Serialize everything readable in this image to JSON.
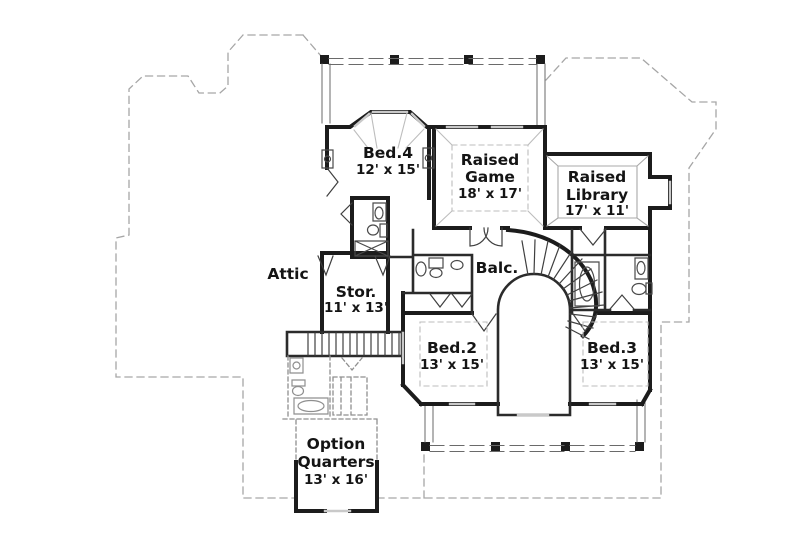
{
  "plan": {
    "rooms": {
      "bed4": {
        "name": "Bed.4",
        "dims": "12' x 15'"
      },
      "raised_game": {
        "line1": "Raised",
        "line2": "Game",
        "dims": "18' x 17'"
      },
      "raised_library": {
        "line1": "Raised",
        "line2": "Library",
        "dims": "17' x 11'"
      },
      "attic": {
        "name": "Attic"
      },
      "storage": {
        "name": "Stor.",
        "dims": "11' x 13'"
      },
      "balcony": {
        "name": "Balc."
      },
      "bed2": {
        "name": "Bed.2",
        "dims": "13' x 15'"
      },
      "bed3": {
        "name": "Bed.3",
        "dims": "13' x 15'"
      },
      "option_quarters": {
        "line1": "Option",
        "line2": "Quarters",
        "dims": "13' x 16'"
      }
    },
    "colors": {
      "background": "#ffffff",
      "wall": "#1c1c1c",
      "wall_medium": "#2b2b2b",
      "thin": "#3f3f3f",
      "roof_dashed": "#a6a6a6",
      "window": "#c9c9c9",
      "tray_dashed": "#bdbdbd",
      "library_tray": "#a8a8a8",
      "fixture": "#4a4a4a",
      "optional": "#8f8f8f",
      "rail": "#6a6a6a",
      "text": "#141414"
    }
  }
}
